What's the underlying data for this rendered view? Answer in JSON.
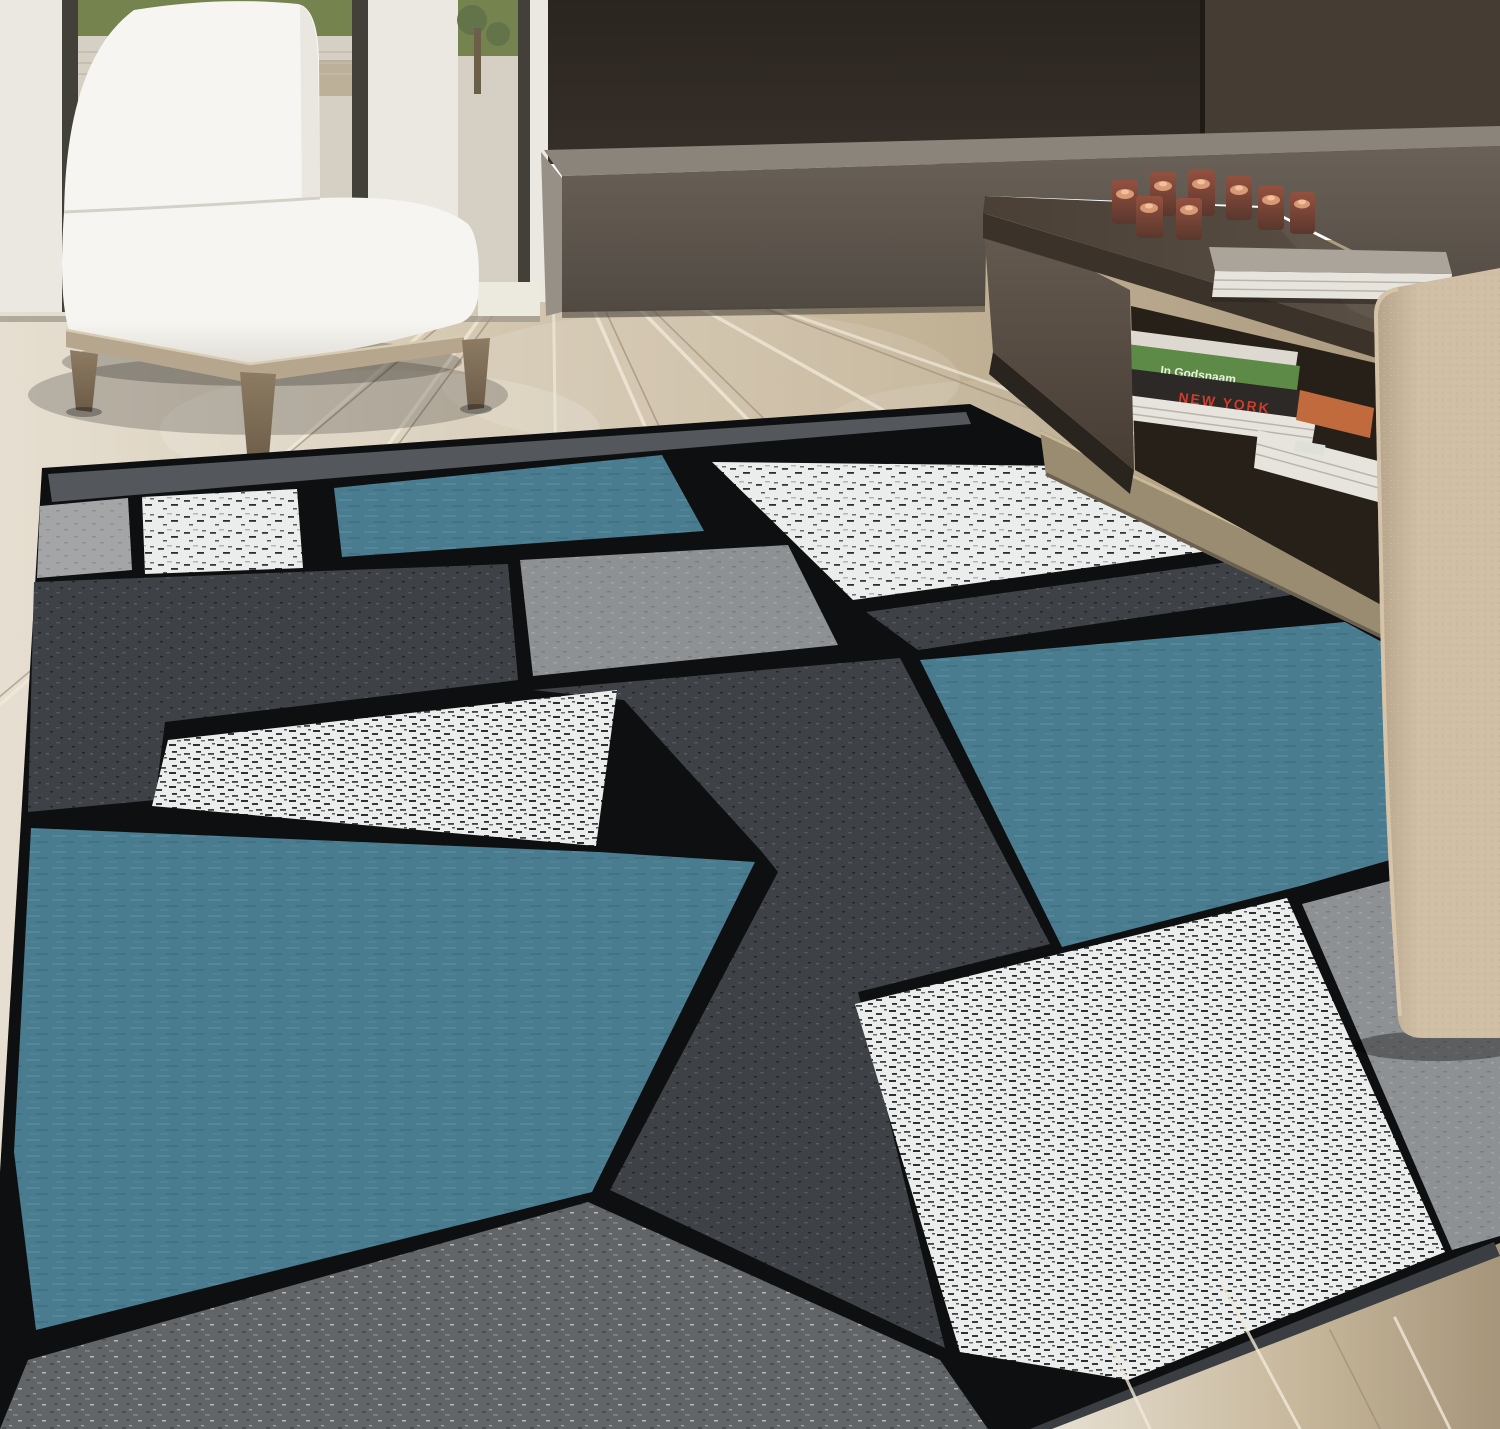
{
  "meta": {
    "description": "Product lifestyle photo of a modern geometric boxes area rug (blue, gray, white, black color-blocked squares) in a contemporary living room with a white slipper chair, light wood floor, dark brown media wall with low bench, a dark coffee table holding votive candles and a book, a shelf of books and magazines, and a beige fabric chair in the right foreground.",
    "width": 1500,
    "height": 1429
  },
  "books": {
    "green_spine": "In Godsnaam",
    "dark_spine": "NEW YORK"
  },
  "scene": {
    "objects": [
      "white slipper chair with wood base",
      "glass patio doors with garden view",
      "light oak plank floor",
      "dark brown accent wall",
      "gray low bench ledge",
      "dark brown coffee table with open shelf",
      "red glass votive candles",
      "white hardcover book",
      "stacked books and magazines",
      "beige upholstered chair",
      "modern boxes area rug in blue gray white black"
    ]
  },
  "colors": {
    "wall_dark_top": "#2b2520",
    "wall_dark": "#362f29",
    "wall_panel": "#453c33",
    "wall_seam": "#1f1b17",
    "bench_top": "#8b847b",
    "bench_front": "#6a6259",
    "bench_side": "#969086",
    "bench_shadow": "#4f4840",
    "wall_white": "#ebe8e2",
    "frame_dark": "#43403a",
    "sill_white": "#eceade",
    "glass_green": "#75834f",
    "glass_green2": "#64744a",
    "glass_pale": "#d6cfc3",
    "glass_pale2": "#c2bbae",
    "trunk": "#6b5f4a",
    "deck_item": "#b7a88f",
    "floor_light": "#e6dfd1",
    "floor_mid": "#c7b79b",
    "floor_dark": "#a6957a",
    "plank_light": "#f0e9d8",
    "plank_dark": "#8c7e67",
    "threshold": "#9a9488",
    "chair_white": "#f6f5f1",
    "chair_shade": "#e1ded6",
    "chair_crease": "#d4d1c8",
    "apron_wood": "#b6a68e",
    "apron_hi": "#d8cbb3",
    "leg_wood": "#8d7b63",
    "leg_dark": "#6b5b47",
    "table_top1": "#4a4036",
    "table_top2": "#5e5349",
    "table_slab": "#3b332a",
    "table_face1": "#665c52",
    "table_face2": "#473d34",
    "table_shadow": "#2a241e",
    "shelf_dark": "#262019",
    "rail": "#9a8c71",
    "rail_hi": "#c9ba97",
    "rail_lo": "#6b6150",
    "candle_glass1": "#94513f",
    "candle_glass2": "#5a372d",
    "candle_wax": "#d89a76",
    "candle_glow": "#f2c19b",
    "book_cover": "#aaa49a",
    "book_pages": "#e7e4dd",
    "book_line": "#b9b5ac",
    "green_book": "#5d8a47",
    "green_text": "#eaf2dd",
    "dark_book": "#2c2926",
    "ny_red": "#cd3d2c",
    "mag_orange": "#c06a3e",
    "mag_white": "#e7e4de",
    "slab_white": "#ddd8d0",
    "sticker_white": "#dfe0da",
    "beige1": "#d0bfa5",
    "beige2": "#b3a287",
    "beige_hi": "#dccbb0",
    "beige_dot": "#c1b094",
    "rug_black": "#0e0f11",
    "rug_band": "#54575b",
    "rug_blue": "#4a7c90",
    "rug_blue_hi": "#5d92a6",
    "rug_blue_lo": "#3c6b7e",
    "rug_char": "#3e4246",
    "rug_char_hi": "#585d62",
    "rug_char_lo": "#23262a",
    "rug_gray": "#8e9194",
    "rug_gray_hi": "#a0a3a6",
    "rug_gray_lo": "#7b7e81",
    "rug_lightgray": "#a3a5a7",
    "rug_lightgray_lo": "#8e9092",
    "rug_white": "#ebedec",
    "rug_speck": "#17191b",
    "rug_botgray": "#626568",
    "botgray_hi": "#7d8184",
    "botgray_lo": "#4a4d50",
    "botgray_wh": "#c9ccce",
    "binding": "#3a3e43",
    "shadow": "#000000"
  }
}
